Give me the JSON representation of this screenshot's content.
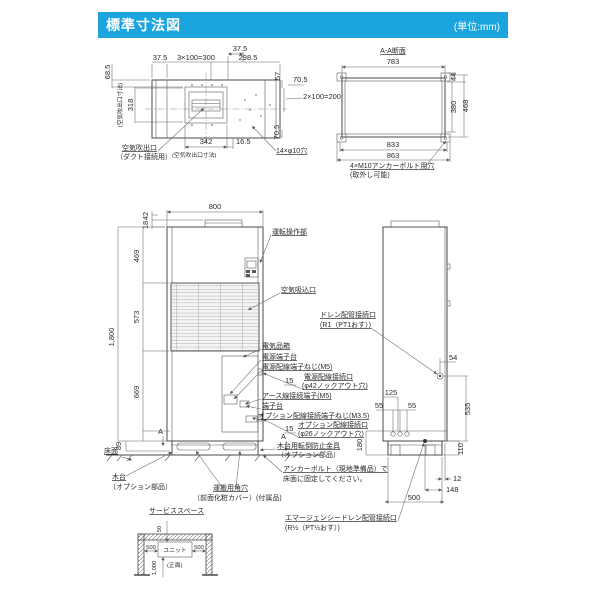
{
  "header": {
    "title": "標準寸法図",
    "unit": "(単位:mm)"
  },
  "top_view": {
    "d_375_top": "37.5",
    "d_375": "37.5",
    "d_3x100": "3×100=300",
    "d_2985": "298.5",
    "d_685": "68.5",
    "lbl_outlet_dim_side": "(空気吹出口寸法)",
    "d_318": "318",
    "d_57": "57",
    "d_705_a": "70.5",
    "d_2x100": "2×100=200",
    "d_705_b": "70.5",
    "d_342": "342",
    "d_165": "16.5",
    "lbl_outlet": "空気吹出口",
    "lbl_outlet_duct": "（ダクト接続用）",
    "lbl_outlet_dim_bottom": "(空気吹出口寸法)",
    "lbl_holes": "14×φ10穴"
  },
  "section_view": {
    "title": "A-A断面",
    "d_783": "783",
    "d_44": "44",
    "d_380": "380",
    "d_468": "468",
    "d_833": "833",
    "d_863": "863",
    "lbl_anchor": "4×M10アンカーボルト用穴",
    "lbl_anchor2": "(取外し可能)"
  },
  "front_view": {
    "d_800": "800",
    "d_42": "42",
    "d_18": "18",
    "d_469": "469",
    "d_573": "573",
    "d_1800": "1,800",
    "d_669": "669",
    "d_89": "89",
    "d_15_a": "15",
    "d_15_b": "15",
    "mark_a_left": "A",
    "mark_a_right": "A",
    "lbl_control": "運転操作部",
    "lbl_intake": "空気吸込口",
    "lbl_elec_box": "電気品箱",
    "lbl_power_terminal": "電源端子台",
    "lbl_power_screw": "電源配線端子ねじ(M5)",
    "lbl_power_port": "電源配線接続口",
    "lbl_power_port2": "(φ42ノックアウト穴)",
    "lbl_earth": "アース線接続端子(M5)",
    "lbl_terminal": "端子台",
    "lbl_opt_screw": "オプション配線接続端子ねじ(M3.5)",
    "lbl_opt_port": "オプション配線接続口",
    "lbl_opt_port2": "(φ26ノックアウト穴)",
    "lbl_floor": "床面",
    "lbl_base": "木台",
    "lbl_base2": "（オプション部品）",
    "lbl_carry": "運搬用角穴",
    "lbl_carry2": "（前面化粧カバー）(付属品)"
  },
  "side_view": {
    "lbl_drain": "ドレン配管接続口",
    "lbl_drain2": "(R1（PT1おす）)",
    "d_54": "54",
    "d_535": "535",
    "d_125": "125",
    "d_55_a": "55",
    "d_55_b": "55",
    "d_180": "180",
    "d_110": "110",
    "d_12": "12",
    "d_148": "148",
    "d_500": "500",
    "lbl_tip": "木台用転倒防止金具",
    "lbl_tip2": "（オプション部品）",
    "lbl_anchor": "アンカーボルト（現地準備品）で",
    "lbl_anchor2": "床面に固定してください。",
    "lbl_edrain": "エマージェンシードレン配管接続口",
    "lbl_edrain2": "(R½（PT½おす）)"
  },
  "service_space": {
    "title": "サービススペース",
    "d_50": "50",
    "d_500_l": "500",
    "d_500_r": "500",
    "d_1000": "1,000",
    "lbl_unit": "ユニット",
    "lbl_front": "(正面)"
  }
}
